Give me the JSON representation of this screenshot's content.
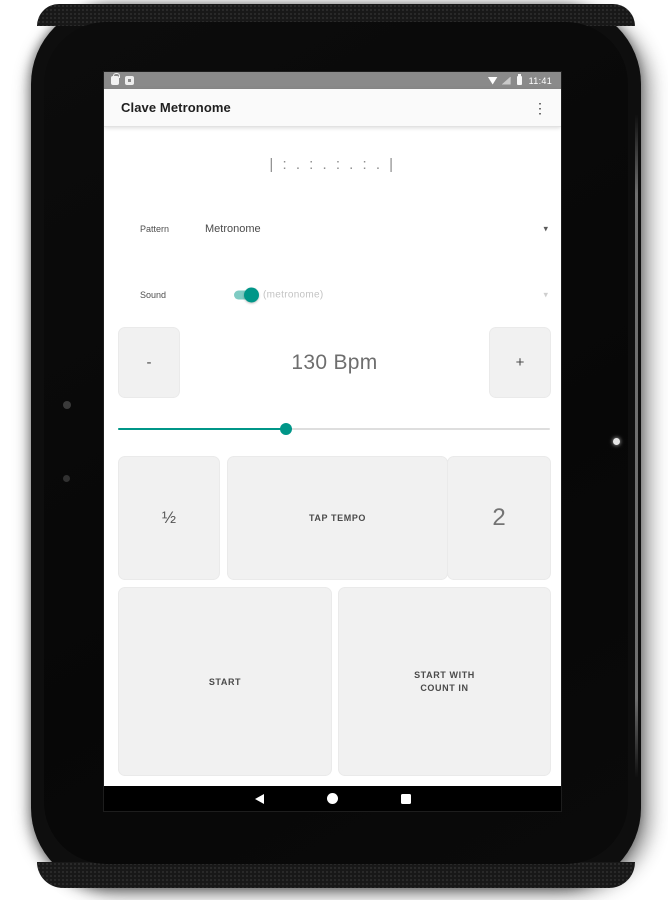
{
  "colors": {
    "accent": "#009688",
    "accent_track": "#7fcbc3",
    "button_bg": "#f1f1f1",
    "status_bar_bg": "#8a8a8a",
    "toolbar_bg": "#fafafa",
    "nav_bar_bg": "#000000"
  },
  "status_bar": {
    "time": "11:41",
    "left_icons": [
      "notification-bag-icon",
      "notification-app-icon"
    ],
    "right_icons": [
      "wifi-icon",
      "cellular-icon",
      "battery-icon"
    ]
  },
  "toolbar": {
    "title": "Clave Metronome",
    "overflow_icon": "⋮"
  },
  "main": {
    "pattern_display": "| : . : . : . : . |",
    "pattern_row": {
      "label": "Pattern",
      "value": "Metronome",
      "dropdown_icon": "▾"
    },
    "sound_row": {
      "label": "Sound",
      "value": "(metronome)",
      "toggle_on": true,
      "dropdown_icon": "▾"
    },
    "tempo": {
      "decrease_label": "-",
      "value": "130 Bpm",
      "increase_label": "+",
      "slider_percent": 38.7
    },
    "modifier_buttons": {
      "half_label": "½",
      "tap_label": "TAP TEMPO",
      "double_label": "2"
    },
    "start_buttons": {
      "start_label": "START",
      "start_count_label": "START WITH\nCOUNT IN"
    }
  },
  "nav_bar": {
    "icons": [
      "back-icon",
      "home-icon",
      "recents-icon"
    ]
  }
}
